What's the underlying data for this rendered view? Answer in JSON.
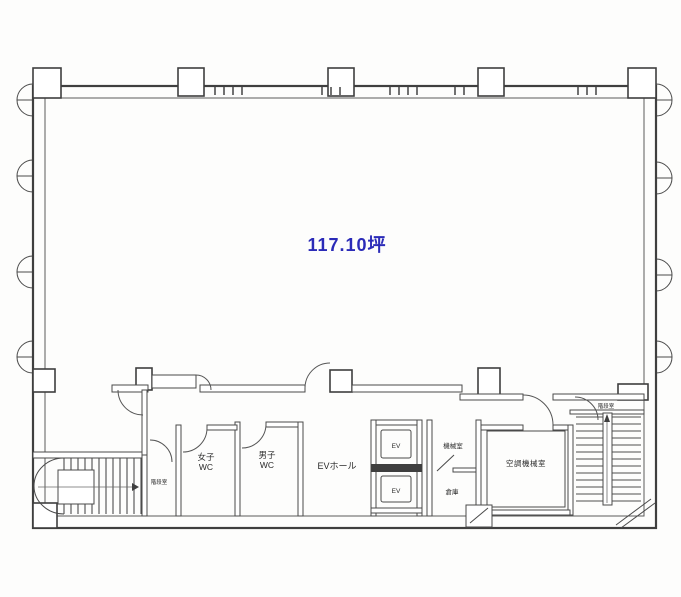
{
  "floorplan": {
    "area_label": "117.10坪",
    "rooms": {
      "womens_wc": {
        "line1": "女子",
        "line2": "WC"
      },
      "mens_wc": {
        "line1": "男子",
        "line2": "WC"
      },
      "ev_hall": "EVホール",
      "elevator_1": "EV",
      "elevator_2": "EV",
      "machine_room": "機械室",
      "storage": "倉庫",
      "hvac_room": "空調機械室",
      "stairwell_left": "階段室",
      "stairwell_right": "階段室"
    },
    "colors": {
      "area_label_text": "#2b2bb8",
      "wall_line": "#4a4a4a",
      "room_label_text": "#2a2a2a",
      "paper": "#fdfdfc"
    }
  }
}
